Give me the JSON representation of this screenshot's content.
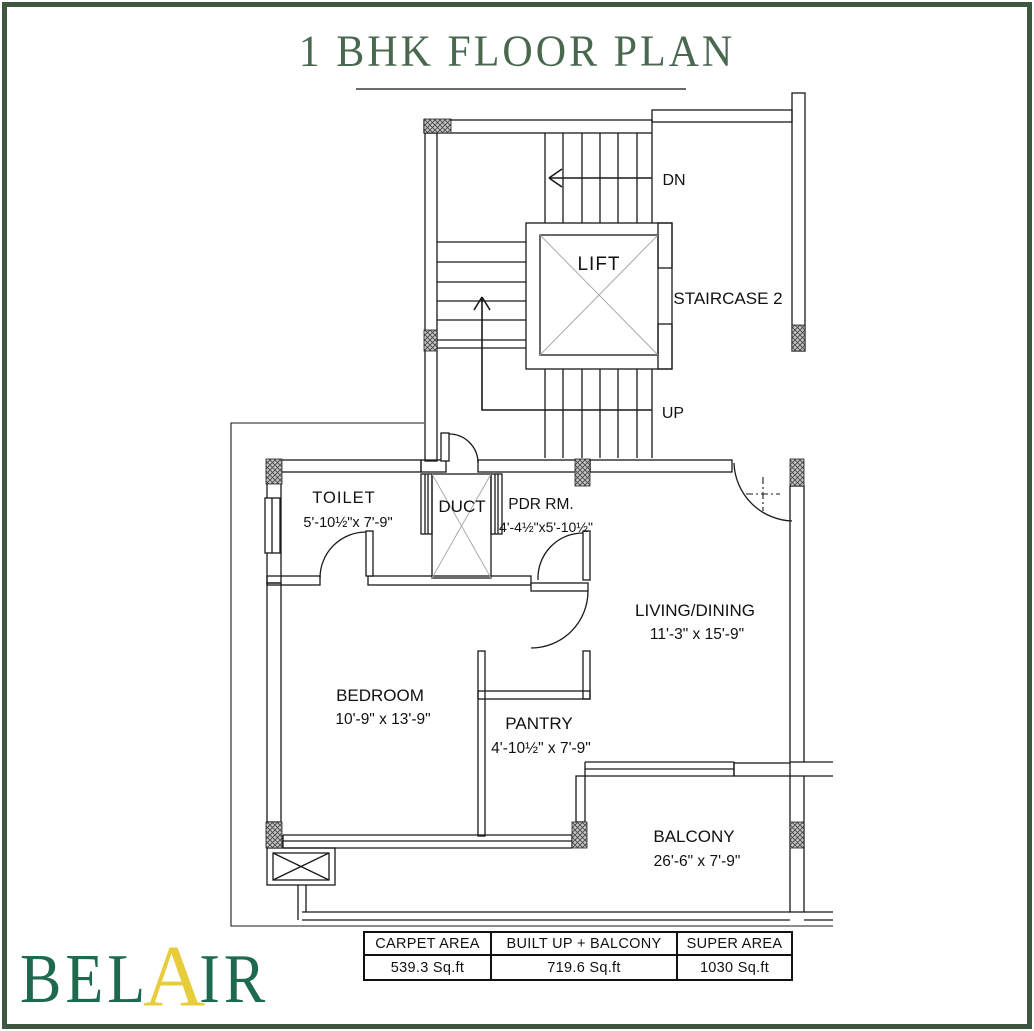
{
  "title": "1 BHK FLOOR PLAN",
  "logo": {
    "part1": "BEL",
    "accent": "A",
    "part2": "IR"
  },
  "plan": {
    "stair": {
      "lift": "LIFT",
      "staircase": "STAIRCASE 2",
      "down": "DN",
      "up": "UP"
    },
    "rooms": {
      "toilet": {
        "name": "TOILET",
        "dim": "5'-10½\"x 7'-9\""
      },
      "duct": {
        "name": "DUCT"
      },
      "pdr": {
        "name": "PDR RM.",
        "dim": "4'-4½\"x5'-10½\""
      },
      "living": {
        "name": "LIVING/DINING",
        "dim": "11'-3\" x 15'-9\""
      },
      "bedroom": {
        "name": "BEDROOM",
        "dim": "10'-9\" x 13'-9\""
      },
      "pantry": {
        "name": "PANTRY",
        "dim": "4'-10½\" x 7'-9\""
      },
      "balcony": {
        "name": "BALCONY",
        "dim": "26'-6\" x 7'-9\""
      }
    }
  },
  "area_table": {
    "headers": [
      "CARPET AREA",
      "BUILT UP + BALCONY",
      "SUPER AREA"
    ],
    "values": [
      "539.3 Sq.ft",
      "719.6 Sq.ft",
      "1030 Sq.ft"
    ]
  },
  "colors": {
    "frame_green": "#3e5741",
    "title_green": "#4a684f",
    "logo_green": "#1e6a4e",
    "logo_yellow": "#e7cc3b",
    "line": "#1a1a1a"
  }
}
